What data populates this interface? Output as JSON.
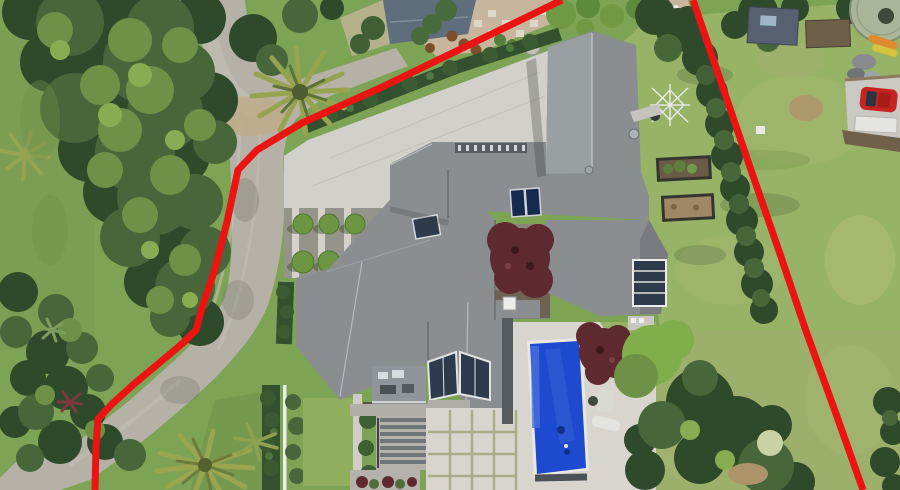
{
  "scene": {
    "type": "aerial-photo",
    "features": [
      "red-property-boundary-overlay",
      "main-house-gray-roof",
      "swimming-pool",
      "pool-loungers",
      "paved-pool-deck",
      "paved-patio",
      "entry-courtyard",
      "topiary-garden",
      "boxwood-hedges",
      "curved-driveway",
      "street-access",
      "clothesline",
      "solar-panels",
      "skylight",
      "conservatory-glass-roof",
      "japanese-maple-courtyard",
      "raised-garden-beds",
      "palm-trees",
      "tropical-garden",
      "lawns",
      "neighbor-house-north",
      "neighbor-gravel-patio",
      "neighbor-sheds",
      "water-tank",
      "red-car",
      "white-trailer",
      "kayaks"
    ]
  },
  "boundary_overlay": {
    "color": "#ec1313",
    "stroke_width": 7,
    "left_line_points": "562,0 380,88 302,123 257,150 238,170 227,222 214,272 202,308 196,330 183,343 158,364 134,384 112,404 98,419 96,446 95,490",
    "right_line_points": "693,0 722,85 751,170 779,251 806,331 835,411 863,490"
  },
  "colors": {
    "lawn_base": "#7da355",
    "lawn_light": "#97b366",
    "lawn_dark": "#6d9348",
    "tree_dark": "#2f4a2b",
    "tree_mid": "#47663a",
    "tree_light": "#6d9247",
    "tree_bright": "#7fae4a",
    "hedge_dark": "#33512e",
    "palm_green": "#96a352",
    "pavement": "#b5b1a7",
    "concrete": "#d2d0ca",
    "paver_light": "#d8d5ce",
    "gravel_tan": "#c7b69d",
    "roof_main": "#8a8e91",
    "roof_sunlit": "#9ba0a3",
    "roof_shade": "#74787b",
    "neighbor_roof_blue": "#5e6e7c",
    "shed_roof_blue": "#566070",
    "glass_dark": "#2d3b4c",
    "pool_blue": "#1d4ace",
    "pool_deep": "#0e2f8e",
    "maple_maroon": "#5e2a30",
    "tank_green": "#a9b69a",
    "car_red": "#c62420",
    "kayak_orange": "#e08a2e",
    "kayak_yellow": "#d6c23c",
    "white_trim": "#eceee9"
  }
}
